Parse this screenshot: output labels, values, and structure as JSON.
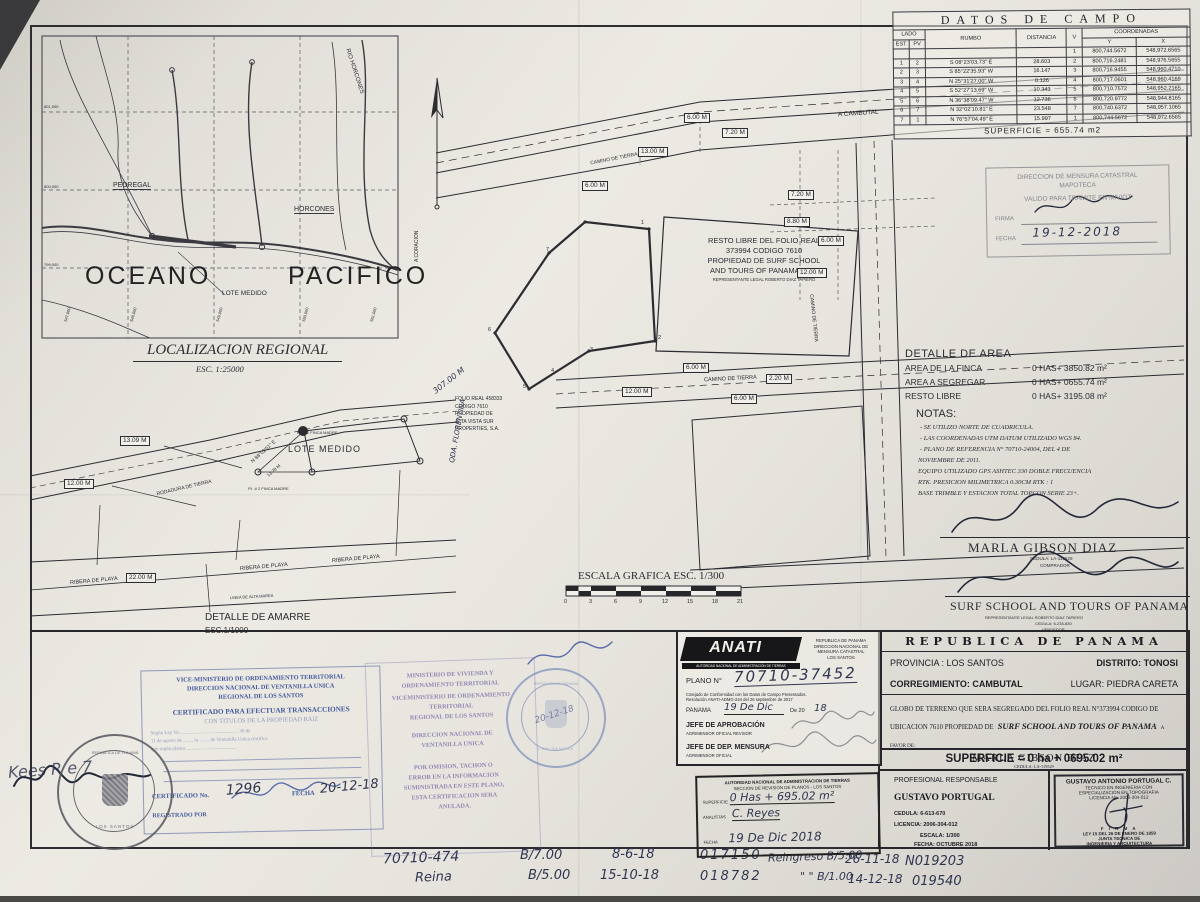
{
  "colors": {
    "paper": "#e8e5df",
    "ink": "#2c2c31",
    "stamp_blue": "#41599c",
    "stamp_purple": "#7b6fa8",
    "hand_ink": "#2f3550"
  },
  "field_table": {
    "title": "DATOS DE CAMPO",
    "headers": {
      "lado": "LADO",
      "est": "EST",
      "pv": "PV",
      "rumbo": "RUMBO",
      "distancia": "DISTANCIA",
      "v": "V",
      "coordenadas": "COORDENADAS",
      "y": "Y",
      "x": "X"
    },
    "rows": [
      {
        "est": "",
        "pv": "",
        "rumbo": "",
        "dist": "",
        "v": "1",
        "cy": "800,744.5672",
        "cx": "548,972.6565"
      },
      {
        "est": "1",
        "pv": "2",
        "rumbo": "S 08°23'03.73\" E",
        "dist": "28.603",
        "v": "2",
        "cy": "800,716.2481",
        "cx": "548,976.5655"
      },
      {
        "est": "2",
        "pv": "3",
        "rumbo": "S 85°22'35.93\" W",
        "dist": "16.147",
        "v": "3",
        "cy": "800,716.9455",
        "cx": "548,960.4710"
      },
      {
        "est": "3",
        "pv": "4",
        "rumbo": "N 25°31'27.00\" W",
        "dist": "0.126",
        "v": "4",
        "cy": "800,717.0601",
        "cx": "548,960.4169"
      },
      {
        "est": "4",
        "pv": "5",
        "rumbo": "S 52°27'13.69\" W",
        "dist": "10.343",
        "v": "5",
        "cy": "800,710.7572",
        "cx": "548,952.2165"
      },
      {
        "est": "5",
        "pv": "6",
        "rumbo": "N 36°38'09.47\" W",
        "dist": "12.736",
        "v": "6",
        "cy": "800,720.9772",
        "cx": "548,944.8165"
      },
      {
        "est": "6",
        "pv": "7",
        "rumbo": "N 32°02'10.81\" E",
        "dist": "23.548",
        "v": "7",
        "cy": "800,740.6372",
        "cx": "548,957.1065"
      },
      {
        "est": "7",
        "pv": "1",
        "rumbo": "N 76°57'04.49\" E",
        "dist": "15.997",
        "v": "1",
        "cy": "800,744.5672",
        "cx": "548,972.6565"
      }
    ],
    "superficie": "SUPERFICIE  =  655.74  m2"
  },
  "mapoteca_stamp": {
    "line1": "DIRECCION DE MENSURA CATASTRAL",
    "line2": "MAPOTECA",
    "line3": "VALIDO PARA TRAMITE EN MIVIOT",
    "firma_label": "FIRMA",
    "fecha_label": "FECHA",
    "fecha_value": "19-12-2018"
  },
  "area_detail": {
    "title": "DETALLE DE AREA",
    "rows": [
      {
        "label": "AREA DE LA FINCA",
        "value": "0 HAS+ 3850.82 m²"
      },
      {
        "label": "AREA A SEGREGAR",
        "value": "0 HAS+ 0655.74 m²"
      },
      {
        "label": "RESTO LIBRE",
        "value": "0 HAS+ 3195.08 m²"
      }
    ]
  },
  "notes": {
    "title": "NOTAS:",
    "items": [
      "- SE UTILIZO NORTE DE CUADRICULA.",
      "- LAS COORDENADAS UTM DATUM UTILIZADO WGS 84.",
      "- PLANO DE REFERENCIA N° 70710-24004, DEL 4 DE",
      "NOVIEMBRE DE 2011.",
      "EQUIPO UTILIZADO GPS ASHTEC 330 DOBLE FRECUENCIA",
      "RTK. PRESICION MILIMETRICA 0.30CM RTK : 1",
      "BASE TRIMBLE Y ESTACION TOTAL TOPCON SERIE 23+."
    ]
  },
  "signatures": {
    "buyer": {
      "name": "MARLA GIBSON DIAZ",
      "cedula": "CEDULA: LA-119529",
      "role": "COMPRADOR"
    },
    "seller": {
      "name": "SURF SCHOOL AND TOURS OF PANAMA",
      "rep": "REPRESENTANTE LEGAL ROBERTO DIAZ TAPIERO",
      "cedula": "CEDULA: 6-235-830",
      "role": "VENDEDOR"
    }
  },
  "plan": {
    "a_cambutal": "A CAMBUTAL",
    "camino1": "CAMINO DE TIERRA",
    "camino2": "CAMINO DE TIERRA",
    "camino3": "CAMINO DE TIERRA",
    "a_coracion": "A CORACION",
    "resto": [
      "RESTO LIBRE DEL FOLIO REAL",
      "373994 CODIGO 7610",
      "PROPIEDAD DE SURF SCHOOL",
      "AND TOURS OF PANAMA, S.A.",
      "REPRESENTANTE LEGAL ROBERTO DIAZ TAPIERO"
    ],
    "dims": [
      "6.00 M",
      "7.20 M",
      "13.00 M",
      "6.00 M",
      "7.20 M",
      "8.80 M",
      "6.00 M",
      "12.00 M",
      "6.00 M",
      "2.20 M",
      "6.00 M",
      "12.00 M",
      "13.09 M",
      "12.00 M",
      "22.00 M"
    ],
    "vertices": [
      "1",
      "2",
      "3",
      "4",
      "5",
      "6",
      "7"
    ],
    "folio2": [
      "FOLIO REAL 458333",
      "CODIGO 7610",
      "PROPIEDAD DE",
      "ALTA VISTA SUR",
      "PROPERTIES, S.A."
    ],
    "qda": "QDA. FLORENTINA",
    "m307": "307.00 M",
    "lote": "LOTE MEDIDO",
    "rodadura": "RODADURA DE TIERRA",
    "pi1": "P.I. # 2 FINCA MADRE",
    "pi2": "P.I. # 2 FINCA MADRE",
    "bearing": "N 88°02'51\" E",
    "b1378": "13.78 M",
    "ribera": "RIBERA DE PLAYA",
    "alta": "LINEA DE ALTA MAREA",
    "detalle_amarre": "DETALLE DE AMARRE",
    "esc1000": "ESC.1/1000"
  },
  "inset": {
    "title": "LOCALIZACION REGIONAL",
    "esc": "ESC. 1:25000",
    "oceano": "OCEANO",
    "pacifico": "PACIFICO",
    "pedregal": "PEDREGAL",
    "horcones": "HORCONES",
    "rio": "RIO HORCONES",
    "lote": "LOTE MEDIDO",
    "xcoords": [
      "547,000",
      "548,000",
      "549,000",
      "550,000",
      "551,000"
    ],
    "ycoords": [
      "801,000",
      "800,000",
      "799,000"
    ]
  },
  "scale_bar": {
    "title": "ESCALA GRAFICA  ESC. 1/300",
    "ticks": [
      "0",
      "3",
      "6",
      "9",
      "12",
      "15",
      "18",
      "21"
    ]
  },
  "anati": {
    "logo": "ANATI",
    "logo_sub": "AUTORIDAD NACIONAL DE ADMINISTRACIÓN DE TIERRAS",
    "header": [
      "REPUBLICA DE PANAMA",
      "DIRECCION NACIONAL DE",
      "MENSURA CATASTRAL",
      "LOS SANTOS"
    ],
    "plano_label": "PLANO N°",
    "plano_value": "70710-37452",
    "cotejo": "Cotejado de Conformidad con los Datos de Campo Presentados.",
    "resolucion": "Resolución ANATI-ADMG-244 del 26 septiembre de 2017",
    "panama_label": "PANAMA",
    "panama_date": "19 De Dic",
    "de20": "De 20",
    "year": "18",
    "jefe1": "JEFE DE APROBACIÓN",
    "jefe1_sub": "AGRIMENSOR OFICIAL REVISOR",
    "jefe2": "JEFE DE DEP. MENSURA",
    "jefe2_sub": "AGRIMENSOR OFICIAL"
  },
  "revision_stamp": {
    "line1": "AUTORIDAD NACIONAL DE ADMINISTRACION DE TIERRAS",
    "line2": "SECCION DE REVISION DE PLANOS - LOS SANTOS",
    "superficie_label": "SUPERFICIE",
    "superficie_value": "0 Has + 695.02 m²",
    "analistas_label": "ANALISTAS",
    "analistas_value": "C. Reyes",
    "fecha_label": "FECHA",
    "fecha_value": "19 De Dic 2018"
  },
  "title_block": {
    "country": "REPUBLICA DE PANAMA",
    "provincia": "PROVINCIA : LOS SANTOS",
    "distrito": "DISTRITO: TONOSI",
    "corregimiento": "CORREGIMIENTO: CAMBUTAL",
    "lugar": "LUGAR: PIEDRA CARETA",
    "desc_a": "GLOBO DE TERRENO QUE SERA SEGREGADO DEL FOLIO REAL N°373994  CODIGO DE UBICACION 7610 PROPIEDAD DE",
    "company": "SURF SCHOOL AND TOURS OF PANAMA",
    "a_favor": "A FAVOR DE:",
    "beneficiary": "MARLA GIBSON DIAZ",
    "beneficiary_cedula": "CEDULA: LA-119529",
    "superficie": "SUPERFICIE  =  0 ha + 0695.02 m²"
  },
  "professional": {
    "label": "PROFESIONAL RESPONSABLE",
    "name": "GUSTAVO PORTUGAL",
    "cedula": "CEDULA: 6-613-670",
    "licencia": "LICENCIA: 2006-304-012",
    "escala": "ESCALA: 1/300",
    "fecha": "FECHA: OCTUBRE 2018"
  },
  "portugal_stamp": {
    "name": "GUSTAVO ANTONIO PORTUGAL C.",
    "l2": "TECNICO EN INGENIERIA CON",
    "l3": "ESPECIALIZACION EN TOPOGRAFIA",
    "l4": "LICENCIA No. 2006-304-012",
    "firma": "F I R M A",
    "l5": "LEY 15 DEL 26 DE ENERO DE 1959",
    "l6": "JUNTA TECNICA DE",
    "l7": "INGENIERIA Y ARQUITECTURA"
  },
  "cert_stamp": {
    "l1": "VICE-MINISTERIO DE ORDENAMIENTO TERRITORIAL",
    "l2": "DIRECCION NACIONAL DE VENTANILLA UNICA",
    "l3": "REGIONAL DE LOS SANTOS",
    "l4": "CERTIFICADO PARA EFECTUAR TRANSACCIONES",
    "l5": "CON TITULOS DE LA PROPIEDAD RAIZ",
    "b1": "Según Ley No. ............................................. 36 de",
    "b2": "11 de agosto de ........ la ........ de Ventanilla Unica certifica",
    "b3": "que según planos ........................................",
    "cert_label": "CERTIFICADO No.",
    "cert_value": "1296",
    "fecha_label": "FECHA",
    "fecha_value": "20-12-18",
    "registrado_label": "REGISTRADO POR"
  },
  "warning_stamp": {
    "lines": [
      "MINISTERIO DE VIVIENDA Y",
      "ORDENAMIENTO TERRITORIAL",
      "VICEMINISTERIO DE ORDENAMIENTO",
      "TERRITORIAL",
      "REGIONAL DE LOS SANTOS",
      "DIRECCION NACIONAL DE",
      "VENTANILLA UNICA",
      "POR OMISION, TACHON O",
      "ERROR EN LA INFORMACION",
      "SUMINISTRADA EN ESTE PLANO,",
      "ESTA CERTIFICACION SERA",
      "ANULADA."
    ]
  },
  "seals": {
    "left_top": "REPÚBLICA DE PANAMÁ",
    "left_bottom": "LOS SANTOS",
    "right_top": "REPÚBLICA DE PANAMÁ",
    "right_bottom": "LOS SANTOS",
    "right_date": "20-12-18"
  },
  "handwriting": {
    "margin": "Kees R e 7",
    "items": [
      "70710-474",
      "Reina",
      "B/7.00",
      "B/5.00",
      "8-6-18",
      "15-10-18",
      "017150",
      "018782",
      "Reingreso B/5.00",
      "\" \" B/1.00",
      "26-11-18",
      "14-12-18",
      "N019203",
      "019540"
    ]
  }
}
